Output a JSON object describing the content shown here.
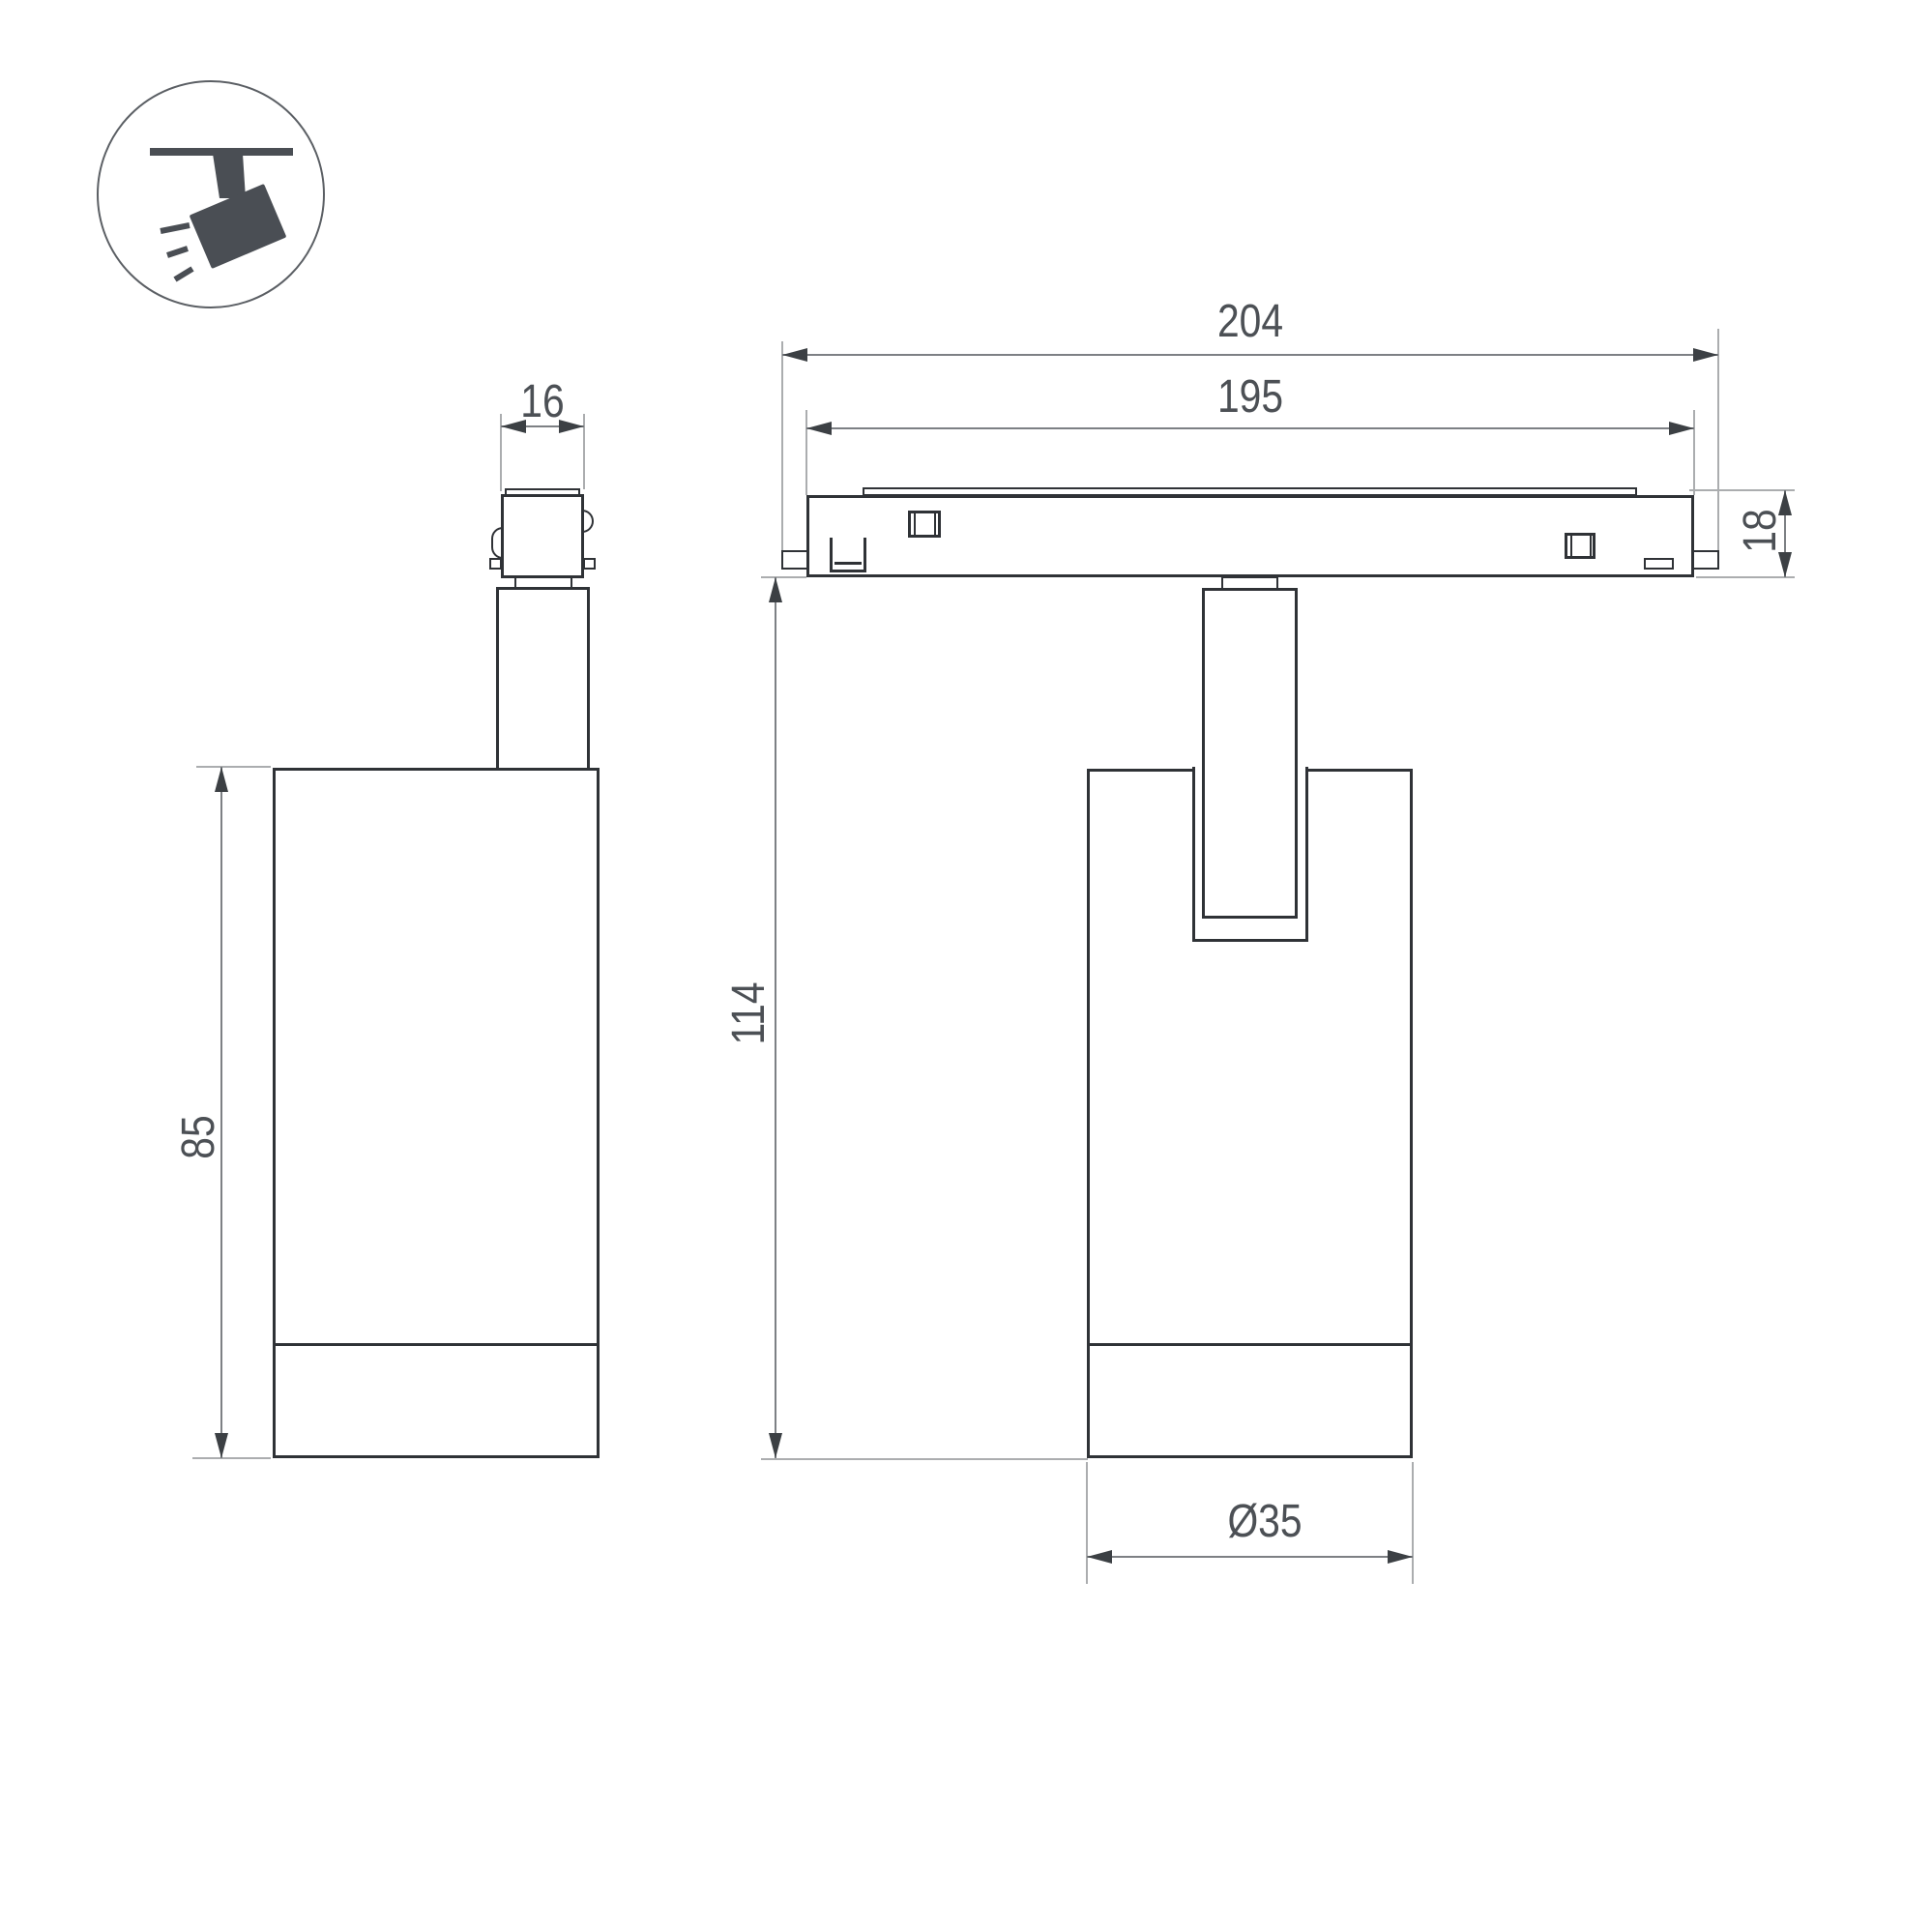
{
  "page": {
    "background": "#ffffff",
    "type": "technical-dimension-drawing"
  },
  "icon": {
    "meaning": "ceiling-track-spotlight-pictogram",
    "color": "#4a4e54",
    "circle_stroke": "#5b5f64"
  },
  "views": {
    "side_view": {
      "dimensions": {
        "adapter_width": "16",
        "body_height": "85"
      }
    },
    "front_view": {
      "dimensions": {
        "track_length_overall": "204",
        "track_length_body": "195",
        "track_height": "18",
        "fixture_height": "114",
        "body_diameter": "Ø35"
      }
    }
  },
  "colors": {
    "outline": "#2f3236",
    "dimension_line": "#7d8084",
    "extension_line": "#abadaf",
    "arrow": "#3c4044",
    "text": "#4c5055"
  }
}
